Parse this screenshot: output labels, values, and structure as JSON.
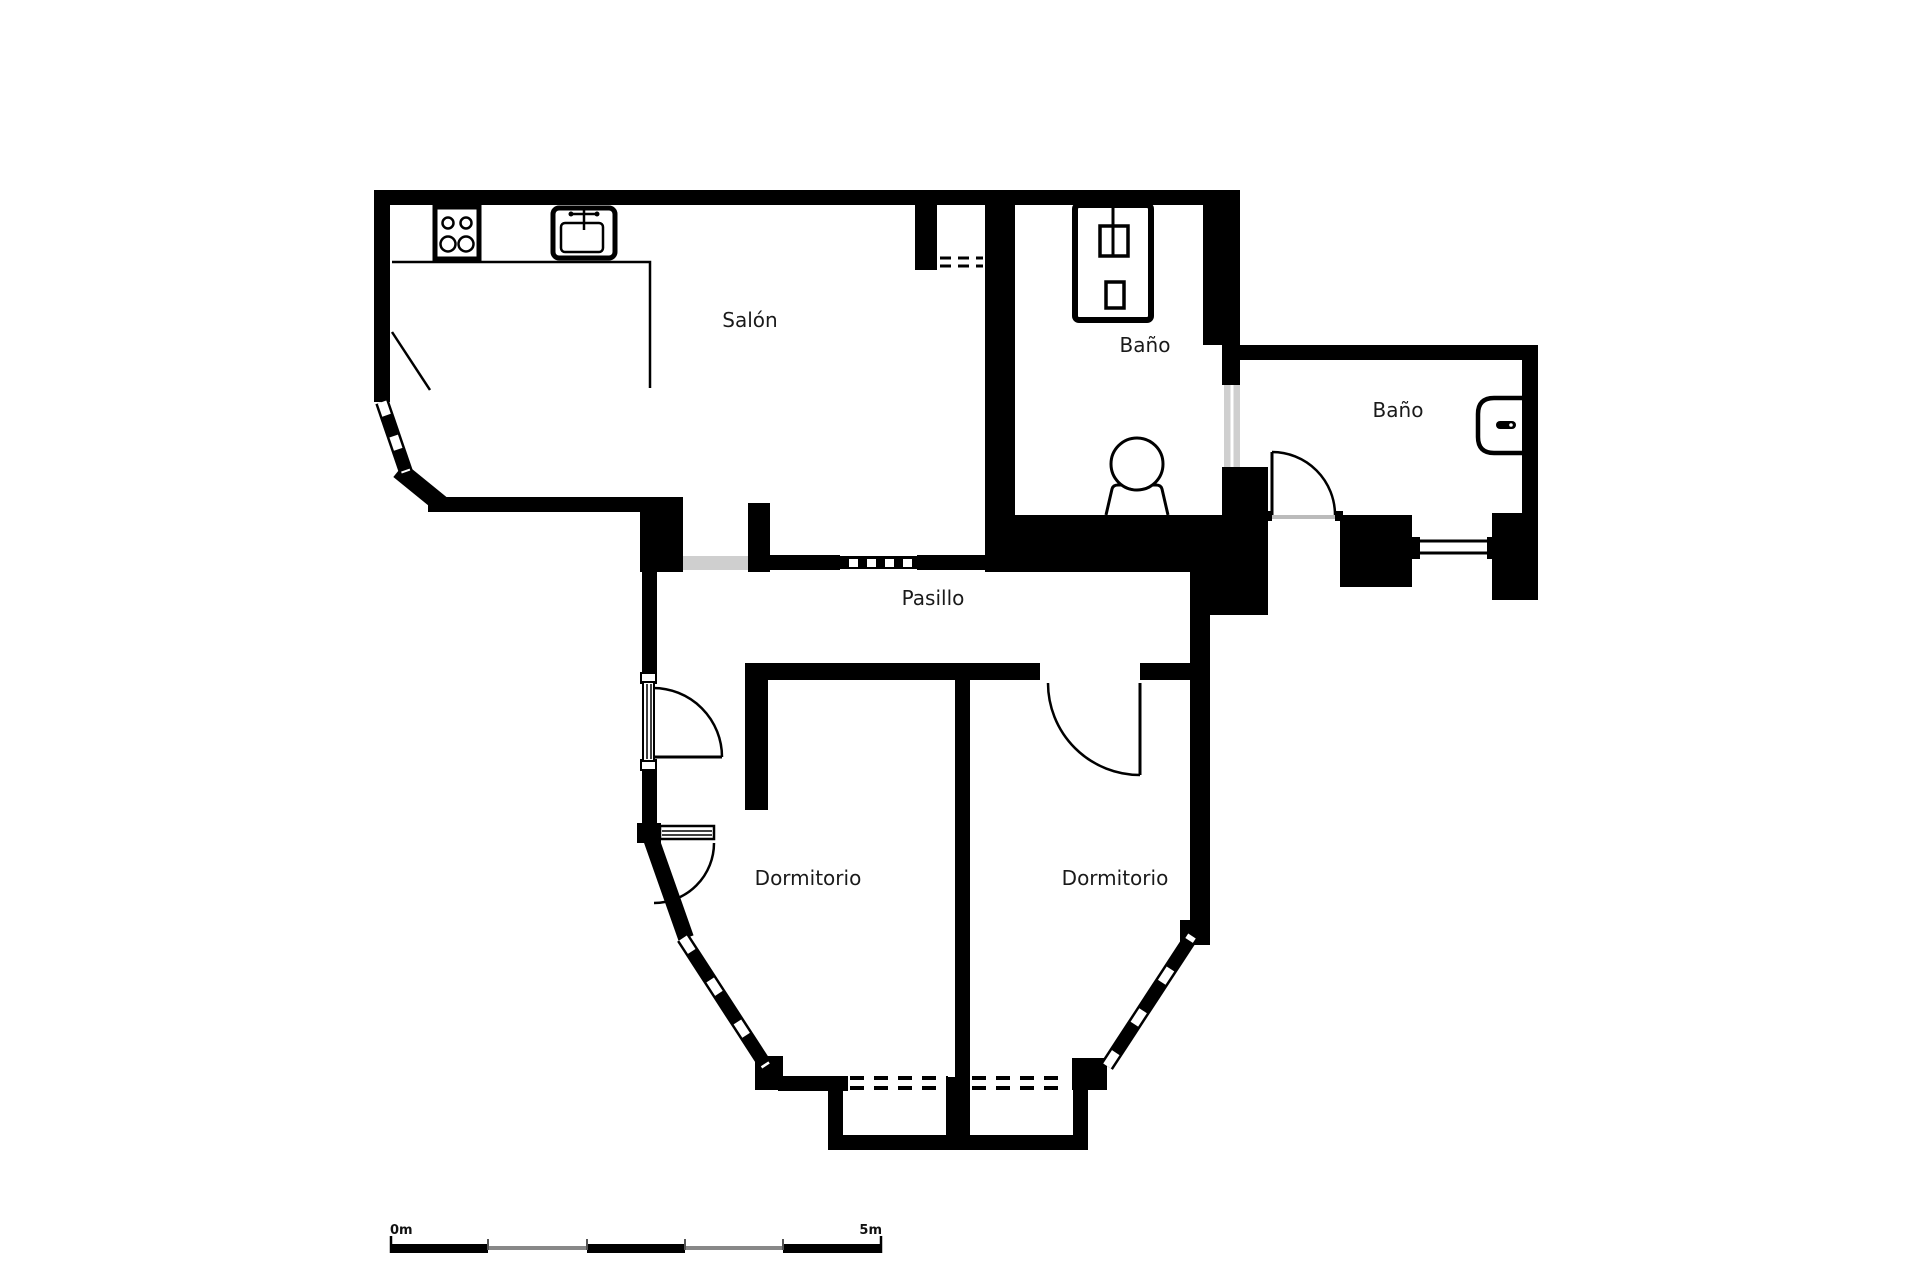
{
  "plan": {
    "type": "apartment-floor-plan",
    "rooms": [
      {
        "id": "salon",
        "label": "Salón"
      },
      {
        "id": "bano-1",
        "label": "Baño"
      },
      {
        "id": "bano-2",
        "label": "Baño"
      },
      {
        "id": "pasillo",
        "label": "Pasillo"
      },
      {
        "id": "dormitorio-1",
        "label": "Dormitorio"
      },
      {
        "id": "dormitorio-2",
        "label": "Dormitorio"
      }
    ],
    "fixtures": [
      "stove-four-burners-icon",
      "kitchen-sink-icon",
      "bathroom-sink-cabinet-icon",
      "toilet-icon",
      "wall-sink-icon"
    ],
    "features": [
      "bay-windows",
      "casement-window-swings",
      "sliding-door-track",
      "glass-partitions",
      "balcony-with-dashed-openings",
      "door-swing-arcs"
    ],
    "colors": {
      "walls": "#000000",
      "background": "#ffffff",
      "glass_partition": "#cfcfcf",
      "text": "#1a1a1a",
      "scale_alt": "#888888"
    }
  },
  "scale_bar": {
    "start_label": "0m",
    "end_label": "5m",
    "segments": 5,
    "units": "meters"
  }
}
